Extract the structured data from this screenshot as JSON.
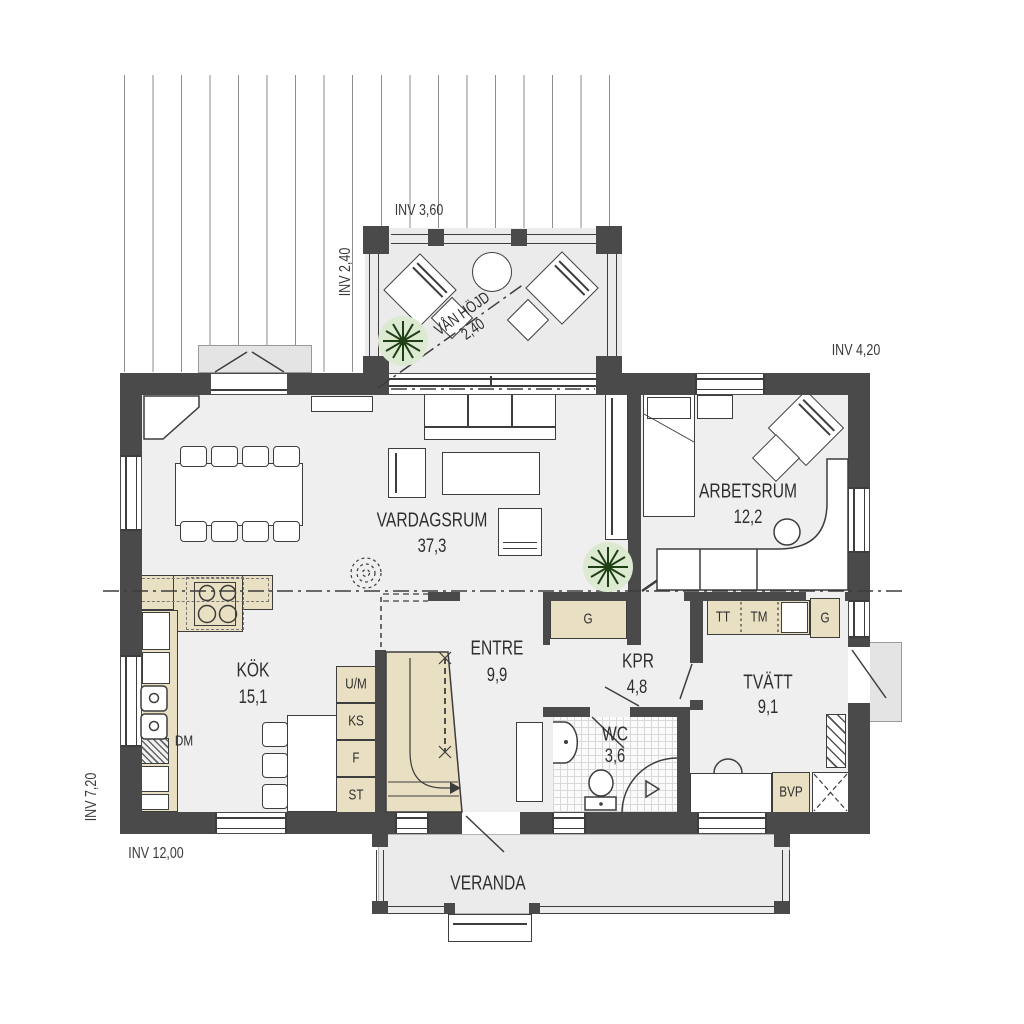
{
  "plan": {
    "dimensions": {
      "top_veranda_width": "INV 3,60",
      "top_veranda_depth": "INV 2,40",
      "right_wing_width": "INV 4,20",
      "house_depth": "INV 7,20",
      "house_width": "INV 12,00"
    },
    "upper_floor_note": {
      "line1": "VÅN HÖJD",
      "line2": "2,40"
    },
    "rooms": {
      "vardagsrum": {
        "name": "VARDAGSRUM",
        "area": "37,3"
      },
      "arbetsrum": {
        "name": "ARBETSRUM",
        "area": "12,2"
      },
      "kok": {
        "name": "KÖK",
        "area": "15,1"
      },
      "entre": {
        "name": "ENTRE",
        "area": "9,9"
      },
      "kpr": {
        "name": "KPR",
        "area": "4,8"
      },
      "wc": {
        "name": "WC",
        "area": "3,6"
      },
      "tvatt": {
        "name": "TVÄTT",
        "area": "9,1"
      },
      "veranda": {
        "name": "VERANDA"
      }
    },
    "fixtures": {
      "dishwasher": "DM",
      "oven_micro": "U/M",
      "fridge": "KS",
      "freezer": "F",
      "pantry": "ST",
      "hall_closet": "G",
      "dryer": "TT",
      "washer": "TM",
      "laundry_closet": "G",
      "heat_pump": "BVP"
    },
    "colors": {
      "wall": "#4a4a4a",
      "floor": "#efefef",
      "cabinet": "#e9dfc2",
      "plant": "#1f3f15"
    }
  }
}
